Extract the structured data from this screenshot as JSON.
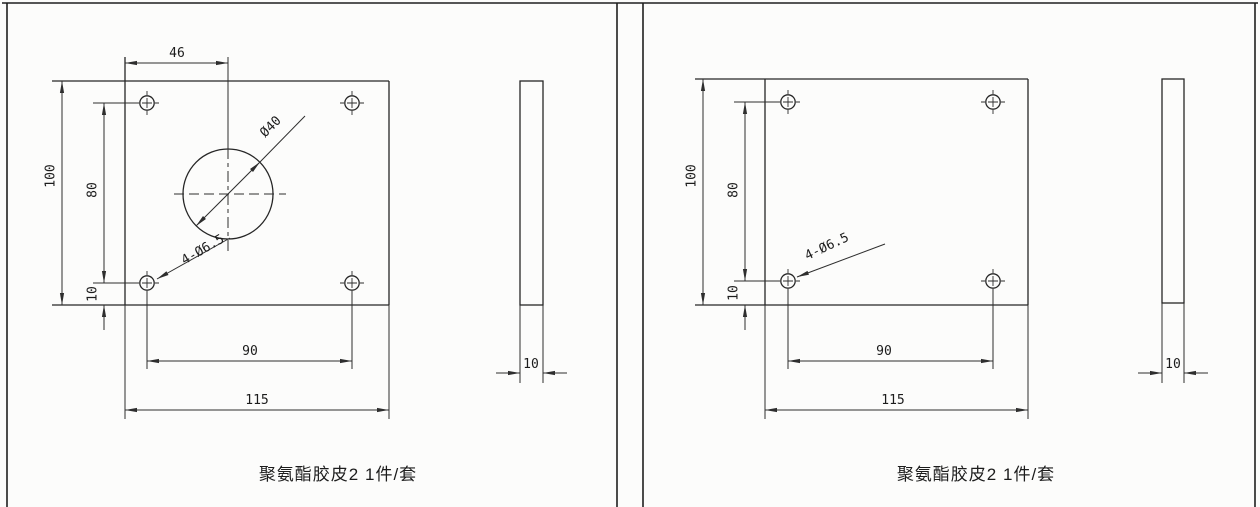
{
  "palette": {
    "background": "#fcfcfb",
    "line": "#2e2e2e",
    "text": "#1c1c1c"
  },
  "sheets": [
    {
      "caption": "聚氨酯胶皮2 1件/套",
      "front_view": {
        "circle_offset": "46",
        "plate_height": "100",
        "hole_spacing_vertical": "80",
        "hole_bottom_margin": "10",
        "hole_spacing_horizontal": "90",
        "plate_width": "115",
        "center_hole_diameter": "Ø40",
        "corner_holes": "4-Ø6.5"
      },
      "side_view": {
        "thickness": "10"
      }
    },
    {
      "caption": "聚氨酯胶皮2 1件/套",
      "front_view": {
        "plate_height": "100",
        "hole_spacing_vertical": "80",
        "hole_bottom_margin": "10",
        "hole_spacing_horizontal": "90",
        "plate_width": "115",
        "corner_holes": "4-Ø6.5"
      },
      "side_view": {
        "thickness": "10"
      }
    }
  ]
}
